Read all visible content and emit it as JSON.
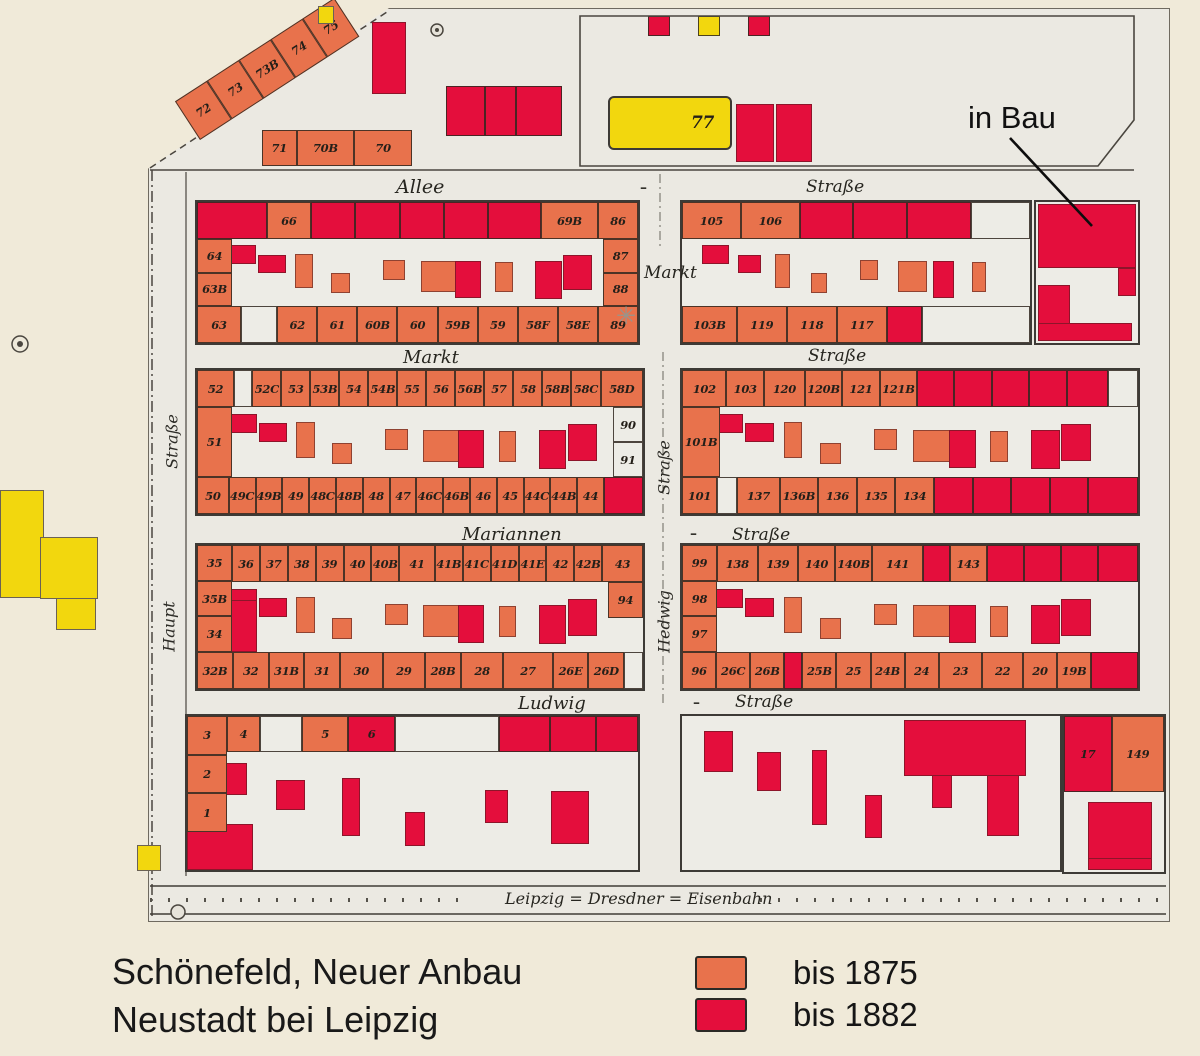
{
  "title": {
    "line1": "Schönefeld, Neuer Anbau",
    "line2": "Neustadt bei Leipzig"
  },
  "legend": {
    "items": [
      {
        "label": "bis 1875",
        "key": "s"
      },
      {
        "label": "bis 1882",
        "key": "r"
      }
    ]
  },
  "annotations": {
    "in_bau": "in Bau"
  },
  "colors": {
    "salmon": "#e8724c",
    "red": "#e40e3c",
    "yellow": "#f2d70e",
    "paper": "#f0ead9",
    "sheet": "#ebe9e2",
    "ink": "#241f19"
  },
  "streets": {
    "allee": "Allee",
    "strasse_top": "Straße",
    "markt_mid": "Markt",
    "markt_row": "Markt",
    "strasse_row1": "Straße",
    "mariannen": "Mariannen",
    "strasse_row2": "Straße",
    "ludwig": "Ludwig",
    "strasse_row3": "Straße",
    "haupt": "Haupt",
    "strasse_west": "Straße",
    "hedwig": "Hedwig",
    "strasse_hedwig": "Straße",
    "railroad": "Leipzig = Dresdner = Eisenbahn",
    "dash": "–",
    "star": "✳"
  },
  "top_strip": {
    "diagonal": [
      {
        "n": "72",
        "c": "s"
      },
      {
        "n": "73",
        "c": "s"
      },
      {
        "n": "73B",
        "c": "s"
      },
      {
        "n": "74",
        "c": "s"
      },
      {
        "n": "75",
        "c": "s"
      }
    ],
    "row70": [
      {
        "n": "71",
        "c": "s",
        "w": 0.7
      },
      {
        "n": "70B",
        "c": "s",
        "w": 1.2
      },
      {
        "n": "70",
        "c": "s",
        "w": 1.2
      }
    ],
    "red_cluster": [
      {
        "c": "r"
      },
      {
        "c": "r",
        "w": 0.8
      },
      {
        "c": "r",
        "w": 1.2
      }
    ],
    "plot77": {
      "n": "77",
      "c": "y"
    },
    "squares": [
      {
        "c": "r"
      },
      {
        "c": "y"
      },
      {
        "c": "r"
      }
    ]
  },
  "blocks": {
    "b1l": {
      "top": [
        {
          "c": "r",
          "w": 1.6
        },
        {
          "n": "66",
          "c": "s"
        },
        {
          "c": "r"
        },
        {
          "c": "r"
        },
        {
          "c": "r"
        },
        {
          "c": "r"
        },
        {
          "c": "r",
          "w": 1.2
        },
        {
          "n": "69B",
          "c": "s",
          "w": 1.3
        },
        {
          "n": "86",
          "c": "s",
          "w": 0.9
        }
      ],
      "left": [
        {
          "n": "64",
          "c": "s"
        },
        {
          "n": "63B",
          "c": "s"
        }
      ],
      "right": [
        {
          "n": "87",
          "c": "s"
        },
        {
          "n": "88",
          "c": "s"
        }
      ],
      "bottom": [
        {
          "n": "63",
          "c": "s",
          "w": 1.1
        },
        {
          "c": "w",
          "w": 0.9
        },
        {
          "n": "62",
          "c": "s"
        },
        {
          "n": "61",
          "c": "s"
        },
        {
          "n": "60B",
          "c": "s"
        },
        {
          "n": "60",
          "c": "s"
        },
        {
          "n": "59B",
          "c": "s"
        },
        {
          "n": "59",
          "c": "s"
        },
        {
          "n": "58F",
          "c": "s"
        },
        {
          "n": "58E",
          "c": "s"
        },
        {
          "n": "89",
          "c": "s"
        }
      ]
    },
    "b1r": {
      "top": [
        {
          "n": "105",
          "c": "s",
          "w": 1.1
        },
        {
          "n": "106",
          "c": "s",
          "w": 1.1
        },
        {
          "c": "r"
        },
        {
          "c": "r"
        },
        {
          "c": "r",
          "w": 1.2
        },
        {
          "c": "w",
          "w": 1.1
        }
      ],
      "bottom": [
        {
          "n": "103B",
          "c": "s",
          "w": 1.1
        },
        {
          "n": "119",
          "c": "s"
        },
        {
          "n": "118",
          "c": "s"
        },
        {
          "n": "117",
          "c": "s"
        },
        {
          "c": "r",
          "w": 0.7
        },
        {
          "c": "w",
          "w": 2.2
        }
      ]
    },
    "b2l": {
      "top": [
        {
          "n": "52",
          "c": "s",
          "w": 1.3
        },
        {
          "c": "w",
          "w": 0.6
        },
        {
          "n": "52C",
          "c": "s"
        },
        {
          "n": "53",
          "c": "s"
        },
        {
          "n": "53B",
          "c": "s"
        },
        {
          "n": "54",
          "c": "s"
        },
        {
          "n": "54B",
          "c": "s"
        },
        {
          "n": "55",
          "c": "s"
        },
        {
          "n": "56",
          "c": "s"
        },
        {
          "n": "56B",
          "c": "s"
        },
        {
          "n": "57",
          "c": "s"
        },
        {
          "n": "58",
          "c": "s"
        },
        {
          "n": "58B",
          "c": "s"
        },
        {
          "n": "58C",
          "c": "s"
        },
        {
          "n": "58D",
          "c": "s",
          "w": 1.5
        }
      ],
      "left": [
        {
          "n": "51",
          "c": "s"
        }
      ],
      "right": [
        {
          "n": "90",
          "c": "w"
        },
        {
          "n": "91",
          "c": "w"
        }
      ],
      "bottom": [
        {
          "n": "50",
          "c": "s",
          "w": 1.2
        },
        {
          "n": "49C",
          "c": "s"
        },
        {
          "n": "49B",
          "c": "s"
        },
        {
          "n": "49",
          "c": "s"
        },
        {
          "n": "48C",
          "c": "s"
        },
        {
          "n": "48B",
          "c": "s"
        },
        {
          "n": "48",
          "c": "s"
        },
        {
          "n": "47",
          "c": "s"
        },
        {
          "n": "46C",
          "c": "s"
        },
        {
          "n": "46B",
          "c": "s"
        },
        {
          "n": "46",
          "c": "s"
        },
        {
          "n": "45",
          "c": "s"
        },
        {
          "n": "44C",
          "c": "s"
        },
        {
          "n": "44B",
          "c": "s"
        },
        {
          "n": "44",
          "c": "s"
        },
        {
          "c": "r",
          "w": 1.5
        }
      ]
    },
    "b2r": {
      "left": [
        {
          "n": "101B",
          "c": "s"
        }
      ],
      "top": [
        {
          "n": "102",
          "c": "s",
          "w": 1.2
        },
        {
          "n": "103",
          "c": "s"
        },
        {
          "n": "120",
          "c": "s",
          "w": 1.1
        },
        {
          "n": "120B",
          "c": "s"
        },
        {
          "n": "121",
          "c": "s"
        },
        {
          "n": "121B",
          "c": "s"
        },
        {
          "c": "r"
        },
        {
          "c": "r"
        },
        {
          "c": "r"
        },
        {
          "c": "r"
        },
        {
          "c": "r",
          "w": 1.1
        },
        {
          "c": "w",
          "w": 0.8
        }
      ],
      "bottom": [
        {
          "n": "101",
          "c": "s",
          "w": 0.9
        },
        {
          "c": "w",
          "w": 0.5
        },
        {
          "n": "137",
          "c": "s",
          "w": 1.1
        },
        {
          "n": "136B",
          "c": "s"
        },
        {
          "n": "136",
          "c": "s"
        },
        {
          "n": "135",
          "c": "s"
        },
        {
          "n": "134",
          "c": "s"
        },
        {
          "c": "r"
        },
        {
          "c": "r"
        },
        {
          "c": "r"
        },
        {
          "c": "r"
        },
        {
          "c": "r",
          "w": 1.3
        }
      ]
    },
    "b3l": {
      "left": [
        {
          "n": "35",
          "c": "s"
        },
        {
          "n": "35B",
          "c": "s"
        },
        {
          "n": "34",
          "c": "s"
        }
      ],
      "top": [
        {
          "n": "36",
          "c": "s"
        },
        {
          "n": "37",
          "c": "s"
        },
        {
          "n": "38",
          "c": "s"
        },
        {
          "n": "39",
          "c": "s"
        },
        {
          "n": "40",
          "c": "s"
        },
        {
          "n": "40B",
          "c": "s"
        },
        {
          "n": "41",
          "c": "s",
          "w": 1.3
        },
        {
          "n": "41B",
          "c": "s"
        },
        {
          "n": "41C",
          "c": "s"
        },
        {
          "n": "41D",
          "c": "s"
        },
        {
          "n": "41E",
          "c": "s"
        },
        {
          "n": "42",
          "c": "s"
        },
        {
          "n": "42B",
          "c": "s"
        },
        {
          "n": "43",
          "c": "s",
          "w": 1.5
        }
      ],
      "right": [
        {
          "n": "94",
          "c": "s"
        }
      ],
      "bottom": [
        {
          "n": "32B",
          "c": "s"
        },
        {
          "n": "32",
          "c": "s"
        },
        {
          "n": "31B",
          "c": "s"
        },
        {
          "n": "31",
          "c": "s"
        },
        {
          "n": "30",
          "c": "s",
          "w": 1.2
        },
        {
          "n": "29",
          "c": "s",
          "w": 1.2
        },
        {
          "n": "28B",
          "c": "s"
        },
        {
          "n": "28",
          "c": "s",
          "w": 1.2
        },
        {
          "n": "27",
          "c": "s",
          "w": 1.4
        },
        {
          "n": "26E",
          "c": "s"
        },
        {
          "n": "26D",
          "c": "s"
        },
        {
          "c": "w",
          "w": 0.5
        }
      ]
    },
    "b3r": {
      "left": [
        {
          "n": "99",
          "c": "s"
        },
        {
          "n": "98",
          "c": "s"
        },
        {
          "n": "97",
          "c": "s"
        }
      ],
      "top": [
        {
          "n": "138",
          "c": "s",
          "w": 1.1
        },
        {
          "n": "139",
          "c": "s",
          "w": 1.1
        },
        {
          "n": "140",
          "c": "s"
        },
        {
          "n": "140B",
          "c": "s"
        },
        {
          "n": "141",
          "c": "s",
          "w": 1.4
        },
        {
          "c": "r",
          "w": 0.7
        },
        {
          "n": "143",
          "c": "s"
        },
        {
          "c": "r"
        },
        {
          "c": "r"
        },
        {
          "c": "r"
        },
        {
          "c": "r",
          "w": 1.1
        }
      ],
      "bottom": [
        {
          "n": "96",
          "c": "s"
        },
        {
          "n": "26C",
          "c": "s"
        },
        {
          "n": "26B",
          "c": "s"
        },
        {
          "c": "r",
          "w": 0.5
        },
        {
          "n": "25B",
          "c": "s"
        },
        {
          "n": "25",
          "c": "s"
        },
        {
          "n": "24B",
          "c": "s"
        },
        {
          "n": "24",
          "c": "s"
        },
        {
          "n": "23",
          "c": "s",
          "w": 1.3
        },
        {
          "n": "22",
          "c": "s",
          "w": 1.2
        },
        {
          "n": "20",
          "c": "s"
        },
        {
          "n": "19B",
          "c": "s"
        },
        {
          "c": "r",
          "w": 1.4
        }
      ]
    },
    "bbl": {
      "left": [
        {
          "n": "3",
          "c": "s"
        },
        {
          "n": "2",
          "c": "s"
        },
        {
          "n": "1",
          "c": "s"
        }
      ],
      "top": [
        {
          "n": "4",
          "c": "s",
          "w": 0.7
        },
        {
          "c": "w",
          "w": 0.9
        },
        {
          "n": "5",
          "c": "s"
        },
        {
          "n": "6",
          "c": "r"
        },
        {
          "c": "w",
          "w": 2.3
        },
        {
          "c": "r",
          "w": 1.1
        },
        {
          "c": "r"
        },
        {
          "c": "r",
          "w": 0.9
        }
      ]
    },
    "corner": {
      "top": [
        {
          "n": "17",
          "c": "r",
          "w": 0.95
        },
        {
          "n": "149",
          "c": "s",
          "w": 1.05
        }
      ]
    }
  }
}
